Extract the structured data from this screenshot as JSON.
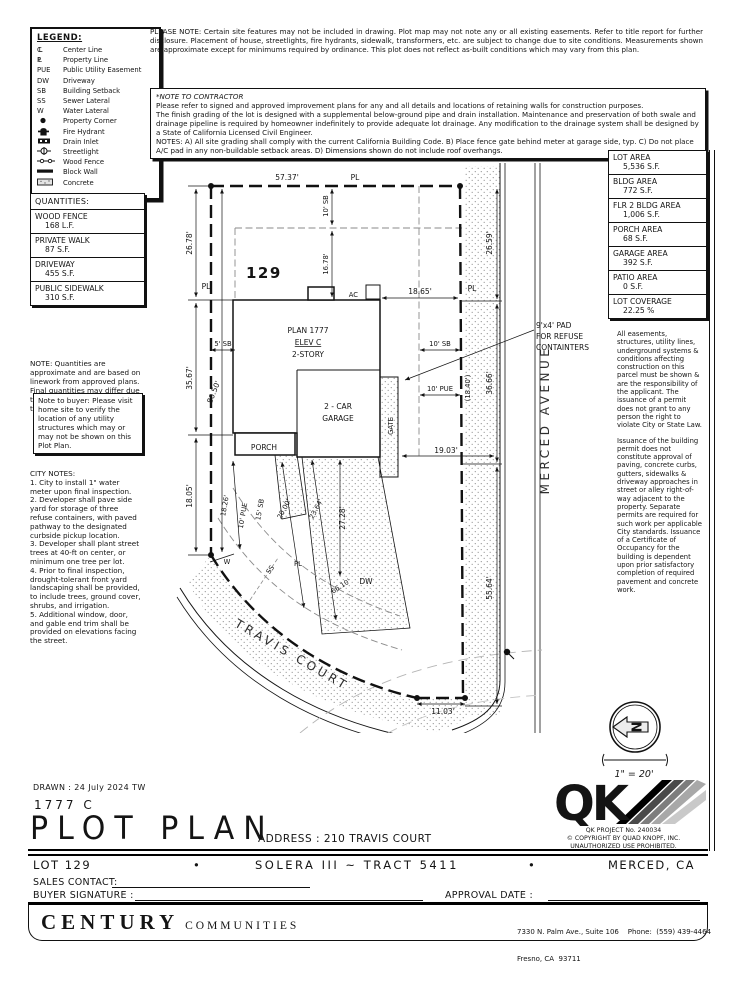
{
  "legend": {
    "title": "LEGEND:",
    "items": [
      {
        "symbol": "CL",
        "label": "Center Line"
      },
      {
        "symbol": "PL",
        "label": "Property Line"
      },
      {
        "symbol": "PUE",
        "label": "Public Utility Easement"
      },
      {
        "symbol": "DW",
        "label": "Driveway"
      },
      {
        "symbol": "SB",
        "label": "Building Setback"
      },
      {
        "symbol": "SS",
        "label": "Sewer Lateral"
      },
      {
        "symbol": "W",
        "label": "Water Lateral"
      },
      {
        "symbol": "",
        "label": "Property Corner"
      },
      {
        "symbol": "",
        "label": "Fire Hydrant"
      },
      {
        "symbol": "",
        "label": "Drain Inlet"
      },
      {
        "symbol": "",
        "label": "Streetlight"
      },
      {
        "symbol": "",
        "label": "Wood Fence"
      },
      {
        "symbol": "",
        "label": "Block Wall"
      },
      {
        "symbol": "",
        "label": "Concrete"
      }
    ]
  },
  "please_note": "PLEASE NOTE:  Certain site features may not be included in drawing.  Plot map may not note any or all existing easements. Refer to title report for further disclosure.  Placement of house, streetlights, fire hydrants, sidewalk, transformers, etc. are subject to change due to site conditions.  Measurements shown are approximate except for minimums required by ordinance.  This plot does not reflect as-built conditions which may vary from this plan.",
  "contractor": {
    "title": "*NOTE TO CONTRACTOR",
    "p1": "Please refer to signed and approved improvement plans for any and all details and locations of retaining walls for construction purposes.",
    "p2": "The finish grading of the lot is designed with a supplemental below-ground pipe and drain installation.  Maintenance and preservation of both swale and drainage pipeline is required by homeowner indefinitely to provide adequate lot drainage.  Any modification to the drainage system shall be designed by a State of California Licensed Civil Engineer.",
    "p3": "NOTES:  A) All site grading shall comply with the current California Building Code.  B) Place fence gate behind meter at garage side, typ.  C) Do not place A/C pad in any non-buildable setback areas.  D) Dimensions shown do not include roof overhangs."
  },
  "quantities": {
    "title": "QUANTITIES:",
    "rows": [
      {
        "name": "WOOD FENCE",
        "value": "168 L.F."
      },
      {
        "name": "PRIVATE WALK",
        "value": "87 S.F."
      },
      {
        "name": "DRIVEWAY",
        "value": "455 S.F."
      },
      {
        "name": "PUBLIC SIDEWALK",
        "value": "310 S.F."
      }
    ],
    "note": "NOTE: Quantities are approximate and are based on linework from approved plans.  Final quantities may differ due to field adjustments at the time of construction."
  },
  "buyer_note": "Note to buyer: Please visit home site to verify the location of any utility structures which may or may not be shown on this Plot Plan.",
  "city_notes": {
    "title": "CITY NOTES:",
    "items": [
      "1. City to install 1\" water meter upon final inspection.",
      "2. Developer shall pave side yard for storage of three refuse containers, with paved pathway to the designated curbside pickup location.",
      "3. Developer shall plant street trees at 40-ft on center, or minimum one tree per lot.",
      "4. Prior to final inspection, drought-tolerant front yard landscaping shall be provided, to include trees, ground cover, shrubs, and irrigation.",
      "5. Additional window, door, and gable end trim shall be provided on elevations facing the street."
    ]
  },
  "areas": {
    "rows": [
      {
        "name": "LOT AREA",
        "value": "5,536 S.F."
      },
      {
        "name": "BLDG AREA",
        "value": "772 S.F."
      },
      {
        "name": "FLR 2 BLDG AREA",
        "value": "1,006 S.F."
      },
      {
        "name": "PORCH AREA",
        "value": "68 S.F."
      },
      {
        "name": "GARAGE AREA",
        "value": "392 S.F."
      },
      {
        "name": "PATIO AREA",
        "value": "0 S.F."
      },
      {
        "name": "LOT COVERAGE",
        "value": "22.25 %"
      }
    ]
  },
  "easements": {
    "p1": "All easements, structures, utility lines, underground systems & conditions affecting construction on this parcel must be shown & are the responsibility of the applicant. The issuance of a permit does not grant to any person the right to violate City or State Law.",
    "p2": "Issuance of the building permit does not constitute approval of paving, concrete curbs, gutters, sidewalks & driveway approaches in street or alley right-of-way adjacent to the property. Separate permits are required for such work per applicable City standards. Issuance of a Certificate of Occupancy for the building is dependent upon prior satisfactory completion of required pavement and concrete work."
  },
  "plot": {
    "lot": "129",
    "plan": "PLAN 1777",
    "elev": "ELEV C",
    "story": "2-STORY",
    "garage_l1": "2 - CAR",
    "garage_l2": "GARAGE",
    "porch": "PORCH",
    "gate": "GATE",
    "ac": "AC",
    "dw": "DW",
    "w": "W",
    "ss": "SS",
    "pl": "PL",
    "travis": "TRAVIS COURT",
    "merced": "MERCED AVENUE",
    "pad_l1": "9'x4' PAD",
    "pad_l2": "FOR REFUSE",
    "pad_l3": "CONTAINTERS",
    "dims": {
      "top": "57.37'",
      "sb_top": "10' SB",
      "front": "16.78'",
      "left_upper": "26.78'",
      "right_upper": "26.59'",
      "ac_to_pl": "18.65'",
      "sb_left": "5' SB",
      "left_mid": "35.67'",
      "depth": "80.50'",
      "sb_right": "10' SB",
      "pue_right": "10' PUE",
      "house_to_pl": "(18.40')",
      "right_mid": "36.66'",
      "gate_to_pl": "19.03'",
      "left_lower": "18.05'",
      "walk": "18.26'",
      "pue_bottom": "10' PUE",
      "sb_15": "15' SB",
      "d20": "20.00'",
      "d2364": "23.64'",
      "d2728": "27.28'",
      "frontage": "66.10'",
      "right_lower": "55.64'",
      "bottom": "11.03'"
    }
  },
  "north": {
    "n": "N",
    "scale": "1\" = 20'"
  },
  "qk": {
    "logo": "QK",
    "l1": "QK PROJECT No. 240034",
    "l2": "©   COPYRIGHT BY QUAD KNOPF, INC.",
    "l3": "UNAUTHORIZED USE PROHIBITED."
  },
  "titleblock": {
    "drawn": "DRAWN :  24 July 2024   TW",
    "plan_code": "1777    C",
    "title": "PLOT PLAN",
    "address": "ADDRESS :   210 TRAVIS COURT",
    "lot": "LOT 129",
    "bullet": "•",
    "tract": "SOLERA III ~ TRACT 5411",
    "city": "MERCED, CA",
    "sales": "SALES CONTACT:",
    "buyer": "BUYER SIGNATURE :",
    "approval": "APPROVAL DATE :"
  },
  "footer": {
    "brand1": "CENTURY",
    "brand2": "COMMUNITIES",
    "addr1": "7330 N. Palm Ave., Suite 106    Phone:  (559) 439-4464",
    "addr2": "Fresno, CA  93711"
  }
}
